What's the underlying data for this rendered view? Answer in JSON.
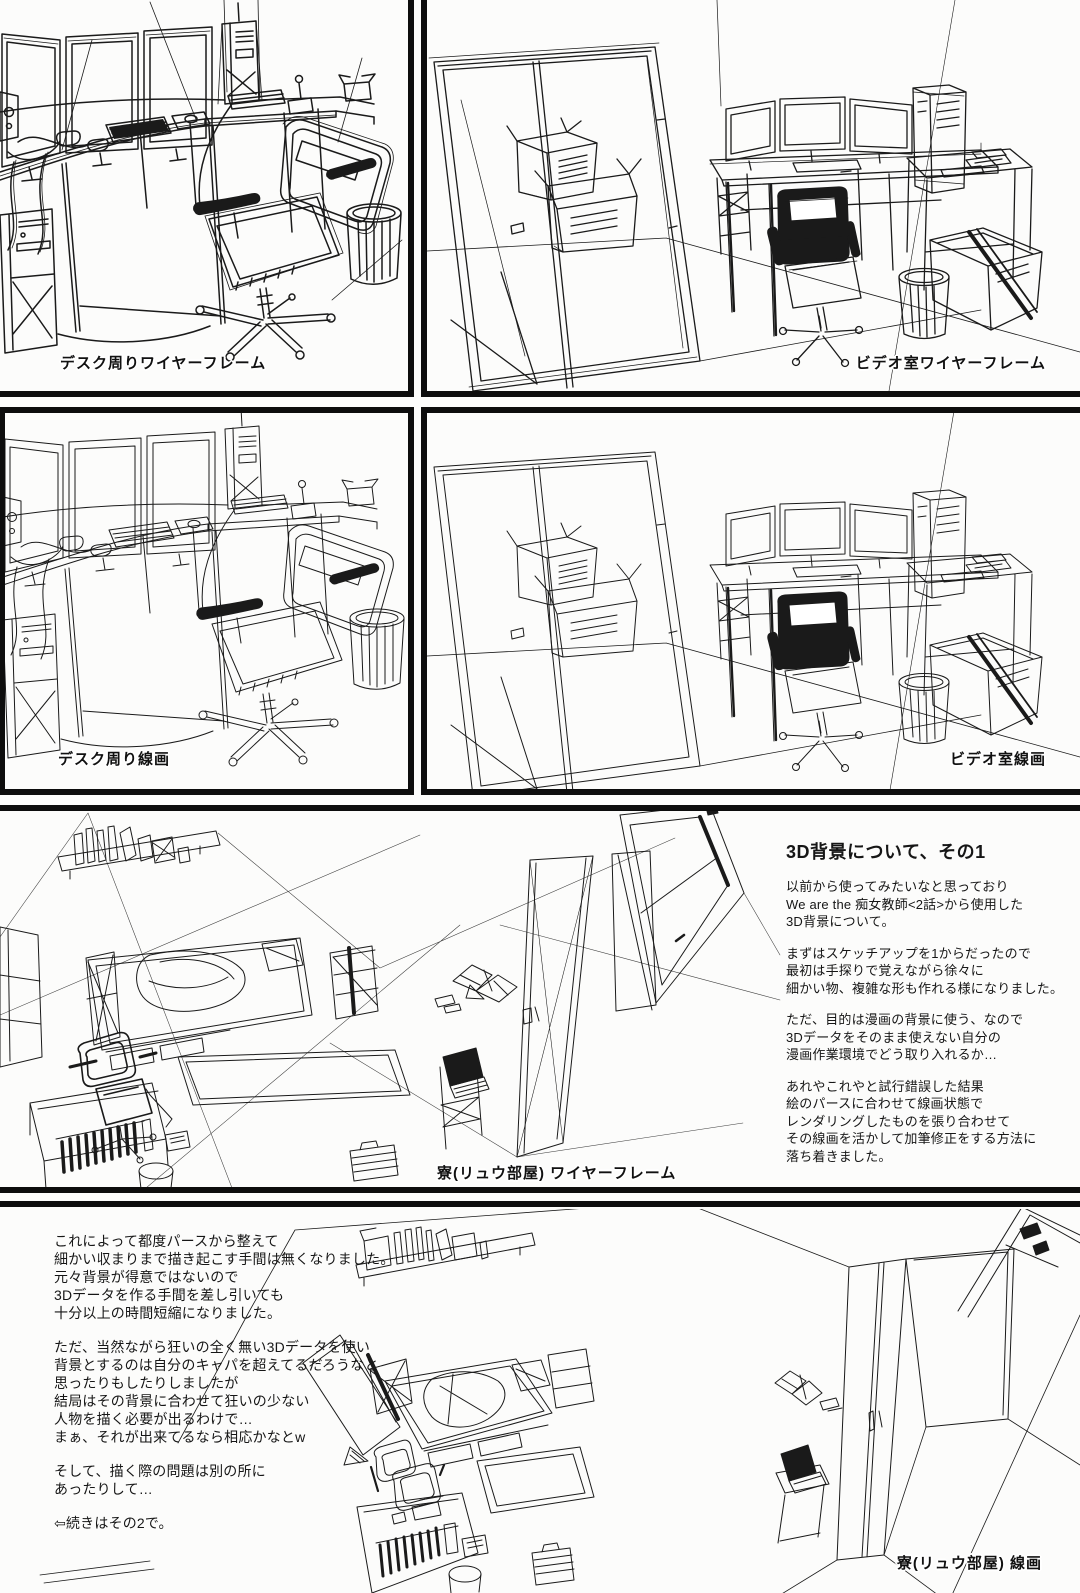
{
  "page": {
    "background": "#fcfcfb",
    "ink": "#1a1a1a"
  },
  "captions": {
    "desk_wireframe": "デスク周りワイヤーフレーム",
    "video_wireframe": "ビデオ室ワイヤーフレーム",
    "desk_lineart": "デスク周り線画",
    "video_lineart": "ビデオ室線画",
    "room_wireframe": "寮(リュウ部屋) ワイヤーフレーム",
    "room_lineart": "寮(リュウ部屋) 線画"
  },
  "article_3d_part1": {
    "title": "3D背景について、その1",
    "p1": "以前から使ってみたいなと思っており\nWe are the 痴女教師<2話>から使用した\n3D背景について。",
    "p2": "まずはスケッチアップを1からだったので\n最初は手探りで覚えながら徐々に\n細かい物、複雑な形も作れる様になりました。",
    "p3": "ただ、目的は漫画の背景に使う、なので\n3Dデータをそのまま使えない自分の\n漫画作業環境でどう取り入れるか…",
    "p4": "あれやこれやと試行錯誤した結果\n絵のパースに合わせて線画状態で\nレンダリングしたものを張り合わせて\nその線画を活かして加筆修正をする方法に\n落ち着きました。"
  },
  "article_3d_part1_cont": {
    "p1": "これによって都度パースから整えて\n細かい収まりまで描き起こす手間は無くなりました。\n元々背景が得意ではないので\n3Dデータを作る手間を差し引いても\n十分以上の時間短縮になりました。",
    "p2": "ただ、当然ながら狂いの全く無い3Dデータを使い\n背景とするのは自分のキャパを超えてるだろうなと\n思ったりもしたりしましたが\n結局はその背景に合わせて狂いの少ない\n人物を描く必要が出るわけで…\nまぁ、それが出来てるなら相応かなとw",
    "p3": "そして、描く際の問題は別の所に\nあったりして…",
    "p4": "⇦続きはその2で。"
  }
}
